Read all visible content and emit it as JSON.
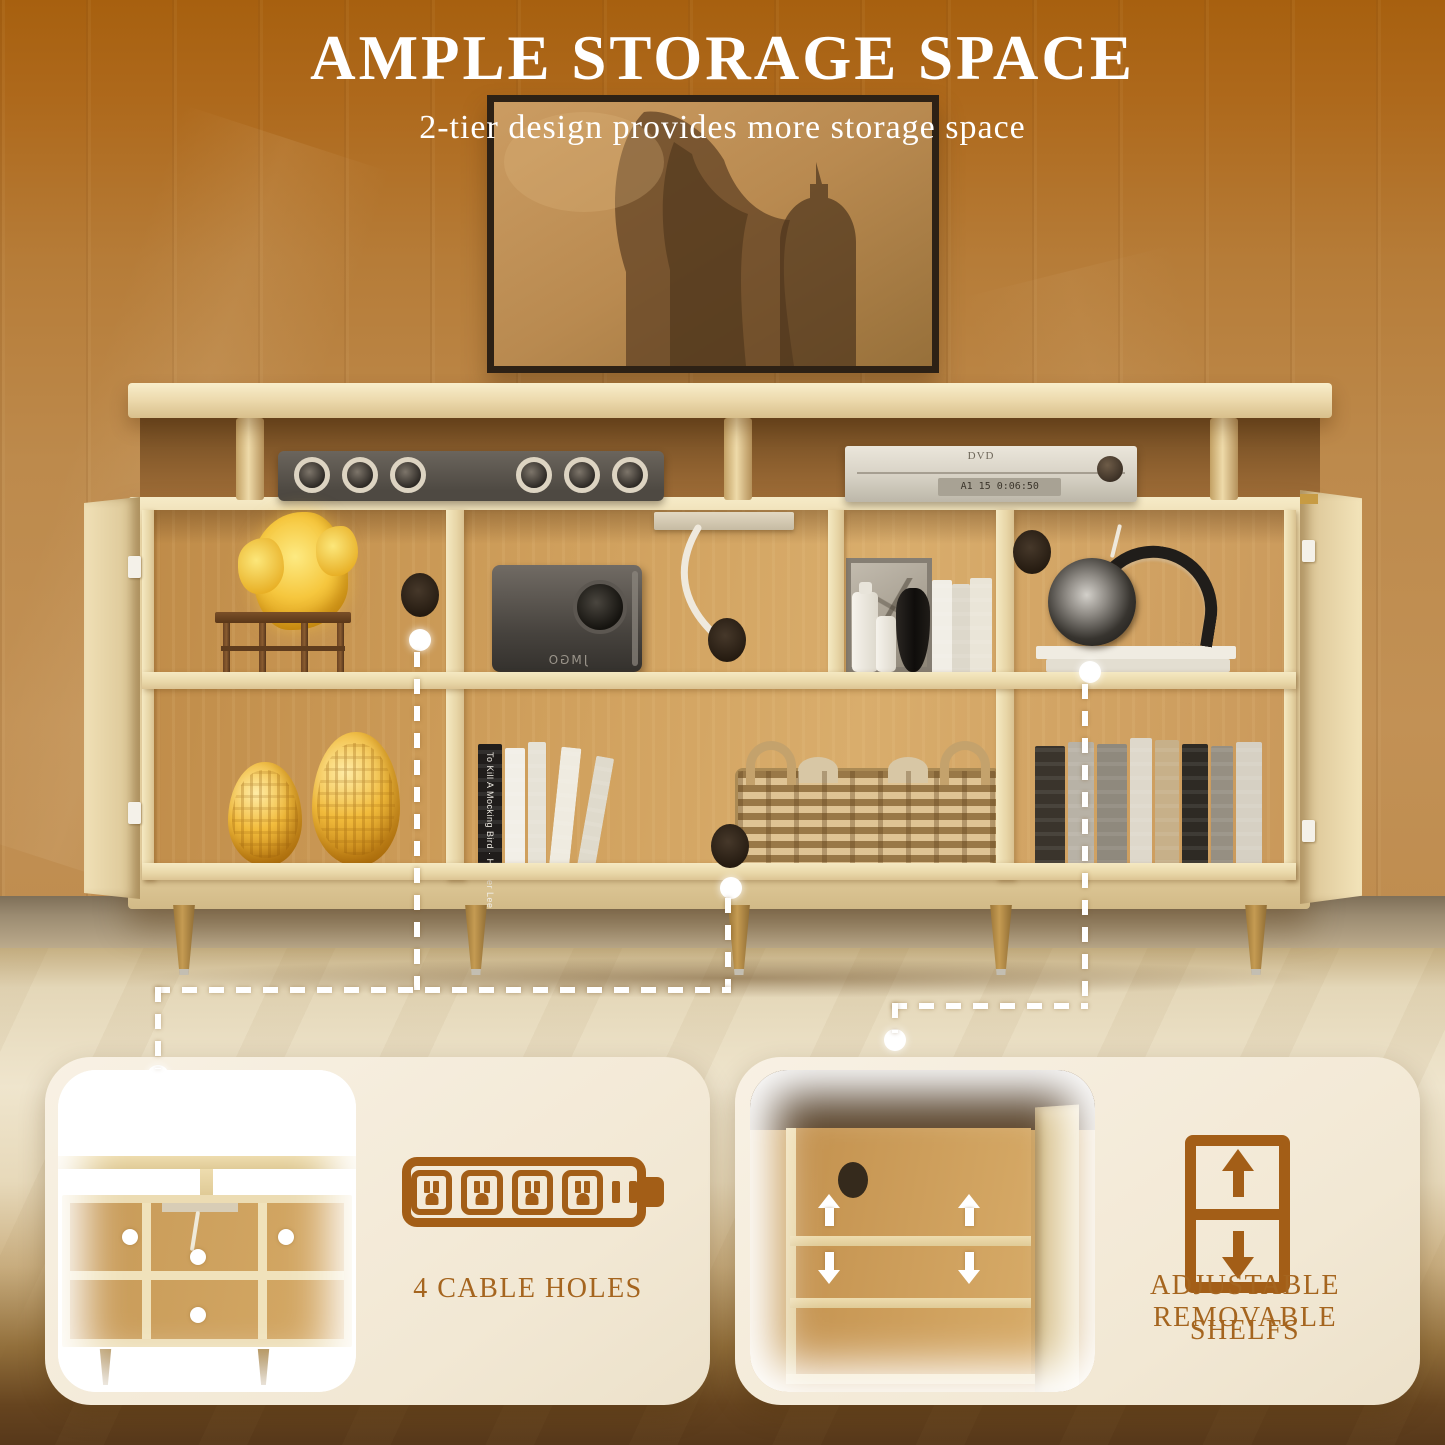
{
  "header": {
    "title": "AMPLE STORAGE SPACE",
    "subtitle": "2-tier design provides more storage space"
  },
  "scene": {
    "projector_label": "JMGO",
    "dvd_label": "DVD",
    "dvd_display": "A1 15 0:06:50",
    "book_spine": "To Kill A Mocking Bird · Harper Lee"
  },
  "cards": [
    {
      "id": "cable-holes",
      "icon": "power-strip-battery-icon",
      "label": "4 CABLE HOLES"
    },
    {
      "id": "adjustable-shelves",
      "icon": "adjustable-shelf-icon",
      "label_line1": "ADJUSTABLE REMOVABLE",
      "label_line2": "SHELFS"
    }
  ],
  "colors": {
    "accent_brown": "#a35e17",
    "label_brown": "#a5651f",
    "card_cream": "#f5eddd",
    "headline_white": "#ffffff"
  }
}
